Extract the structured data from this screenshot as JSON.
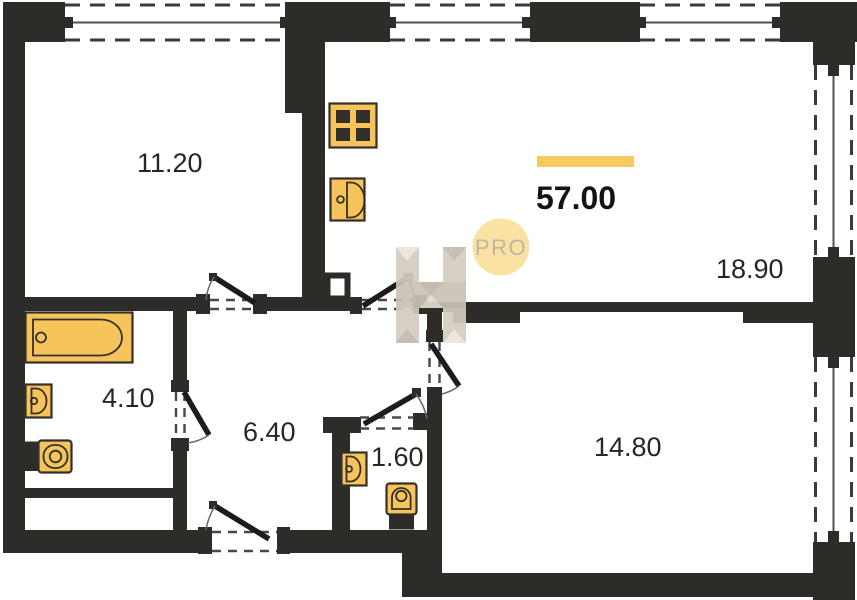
{
  "plan": {
    "total_area_label": "57.00",
    "watermark_badge": "PRO",
    "rooms": [
      {
        "name": "room-11-20",
        "area": "11.20"
      },
      {
        "name": "room-18-90",
        "area": "18.90"
      },
      {
        "name": "room-4-10",
        "area": "4.10"
      },
      {
        "name": "room-6-40",
        "area": "6.40"
      },
      {
        "name": "room-1-60",
        "area": "1.60"
      },
      {
        "name": "room-14-80",
        "area": "14.80"
      }
    ],
    "fixtures": [
      "stove",
      "kitchen-sink",
      "bathtub",
      "bath-sink",
      "toilet",
      "wc-sink",
      "wc-toilet"
    ],
    "colors": {
      "wall": "#2E2C29",
      "fixture": "#F6C45A",
      "fixture_stroke": "#33302C",
      "accent_line": "#F6C963",
      "badge_bg": "#FAE2A3",
      "badge_text": "#BFB5A3",
      "watermark": "#D5CCC1",
      "label_text": "#262626"
    }
  }
}
